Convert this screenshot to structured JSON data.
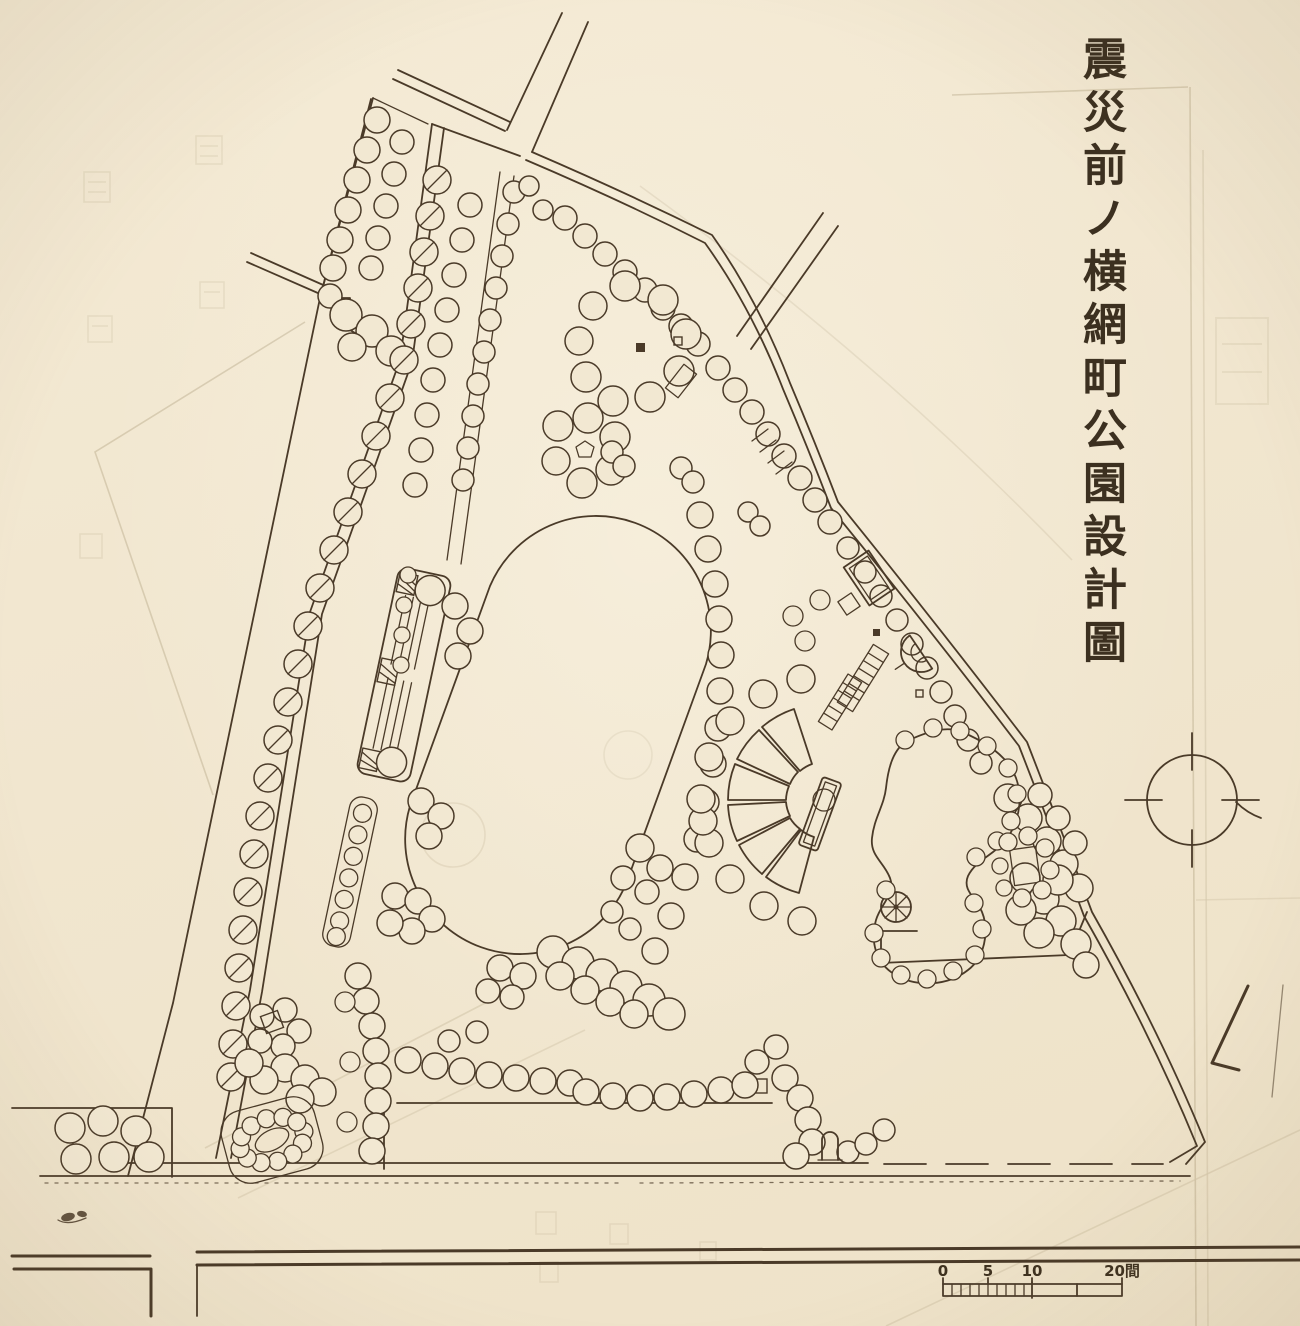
{
  "title": {
    "text": "震災前ノ横網町公園設計圖"
  },
  "scale_bar": {
    "labels": [
      "0",
      "5",
      "10",
      "20間"
    ],
    "unit": "間"
  },
  "colors": {
    "paper": "#f2e8d2",
    "ink": "#4a3a28",
    "title_ink": "#3c3020",
    "bleed": "#9a8a66"
  }
}
